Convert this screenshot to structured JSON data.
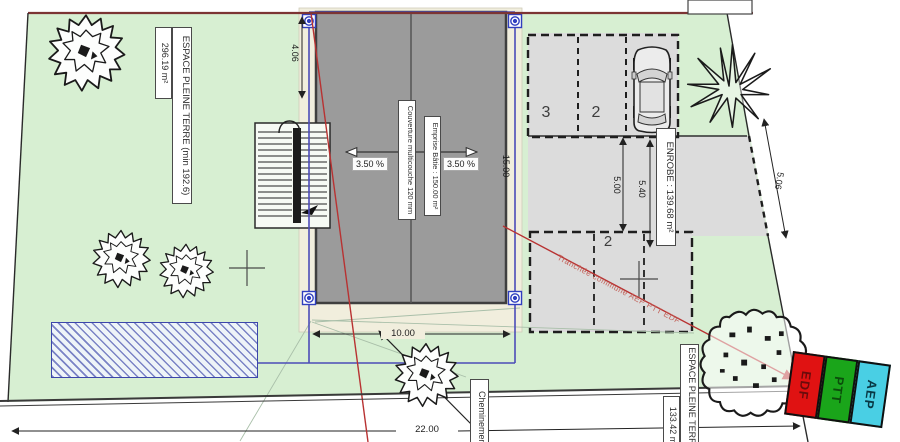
{
  "labels": {
    "espace_top_main": "ESPACE PLEINE TERRE (min 192.6)",
    "espace_top_area": "296.19 m²",
    "couverture": "Couverture multicouche 120 mm",
    "emprise": "Emprise Bâtie : 150.00 m²",
    "enrobe": "ENROBE : 139.68 m²",
    "cheminement": "Cheminement",
    "espace_bottom_main": "ESPACE PLEINE TERRE",
    "espace_bottom_area": "133.42 m²",
    "tranchee": "Tranchée commune AEP PTT EDF",
    "slope_left": "3.50 %",
    "slope_right": "3.50 %"
  },
  "dimensions": {
    "left_offset": "4.06",
    "building_length": "15.00",
    "building_width": "10.00",
    "parking_depth": "5.00",
    "drive_width": "5.40",
    "drive_length": "5.06",
    "street_width": "22.00"
  },
  "parking_spaces": [
    "3",
    "2",
    "2"
  ],
  "utilities": [
    {
      "label": "EDF",
      "color": "#e01212"
    },
    {
      "label": "PTT",
      "color": "#1aa51a"
    },
    {
      "label": "AEP",
      "color": "#49cfe4"
    }
  ],
  "colors": {
    "parcel_green": "#d7efd2",
    "roof_gray": "#9b9b9b",
    "enrobe_gray": "#dcdcdc",
    "slab_beige": "#f1eedd",
    "construction_blue": "#4c4cb8",
    "trench_red": "#b83232",
    "hatch_blue": "#3c46aa"
  }
}
